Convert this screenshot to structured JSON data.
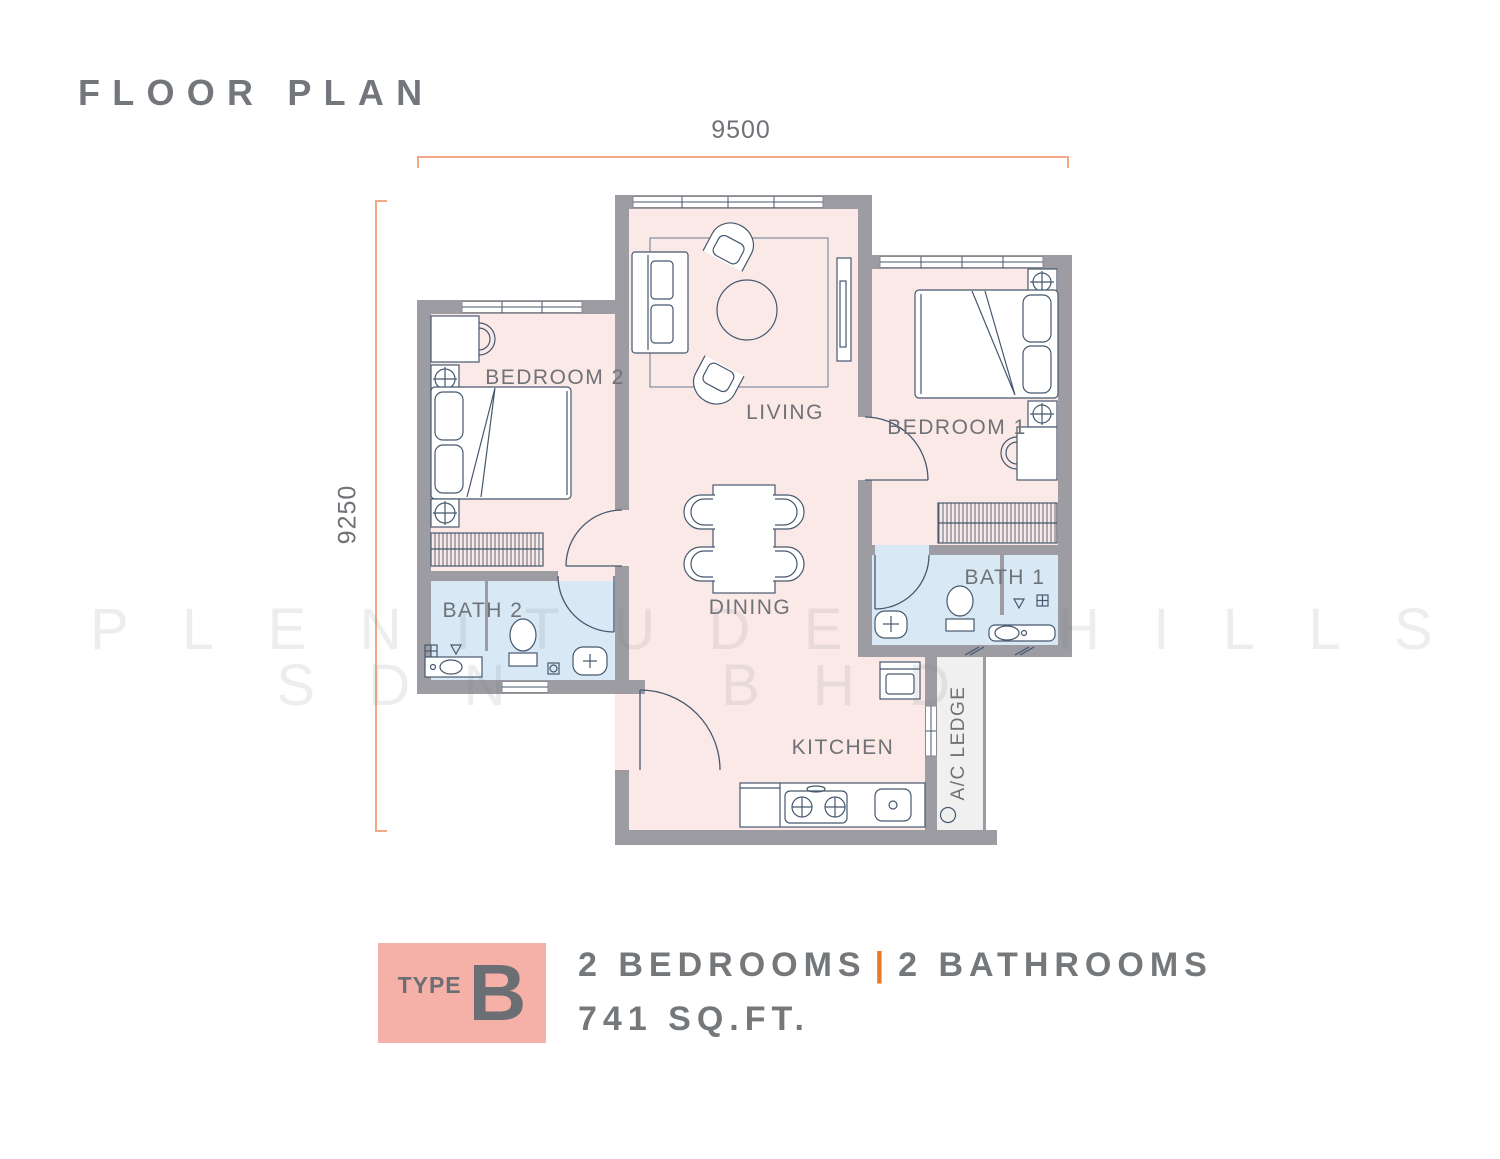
{
  "title": "FLOOR PLAN",
  "dimensions": {
    "width_label": "9500",
    "height_label": "9250"
  },
  "rooms": {
    "bedroom2": "BEDROOM 2",
    "living": "LIVING",
    "bedroom1": "BEDROOM 1",
    "bath2": "BATH 2",
    "dining": "DINING",
    "bath1": "BATH 1",
    "kitchen": "KITCHEN",
    "ac_ledge": "A/C LEDGE"
  },
  "watermark": {
    "line1": "PLENITUDE HILLS",
    "line2": "SDN BHD"
  },
  "legend": {
    "type_label": "TYPE",
    "type_value": "B",
    "bedrooms": "2 BEDROOMS",
    "separator": "|",
    "bathrooms": "2 BATHROOMS",
    "area": "741 SQ.FT."
  },
  "colors": {
    "accent_orange": "#F2A983",
    "separator_orange": "#E8762C",
    "badge_pink": "#F5B1A8",
    "wall_gray": "#9C9CA2",
    "floor_pink": "#FBE9E7",
    "bath_blue": "#D8E9F5",
    "ledge_gray": "#F0F0F0",
    "line_blue": "#46586E",
    "text_gray": "#74777B"
  }
}
